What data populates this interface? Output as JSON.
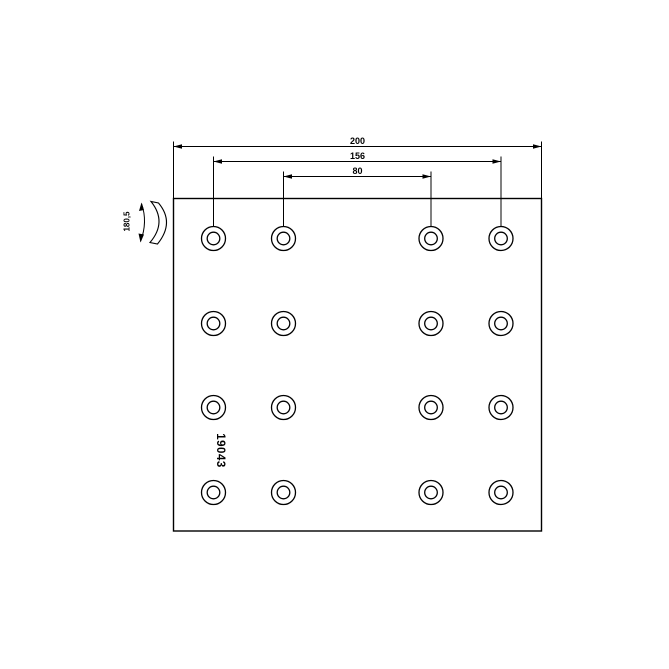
{
  "part_label": "19043",
  "dimensions": {
    "overall_width": "200",
    "outer_hole_spacing": "156",
    "inner_hole_spacing": "80",
    "arc_width": "180,5"
  },
  "holes": {
    "rows": 4,
    "columns": 4,
    "total": 16
  },
  "colors": {
    "line": "#000000",
    "background": "#ffffff"
  }
}
